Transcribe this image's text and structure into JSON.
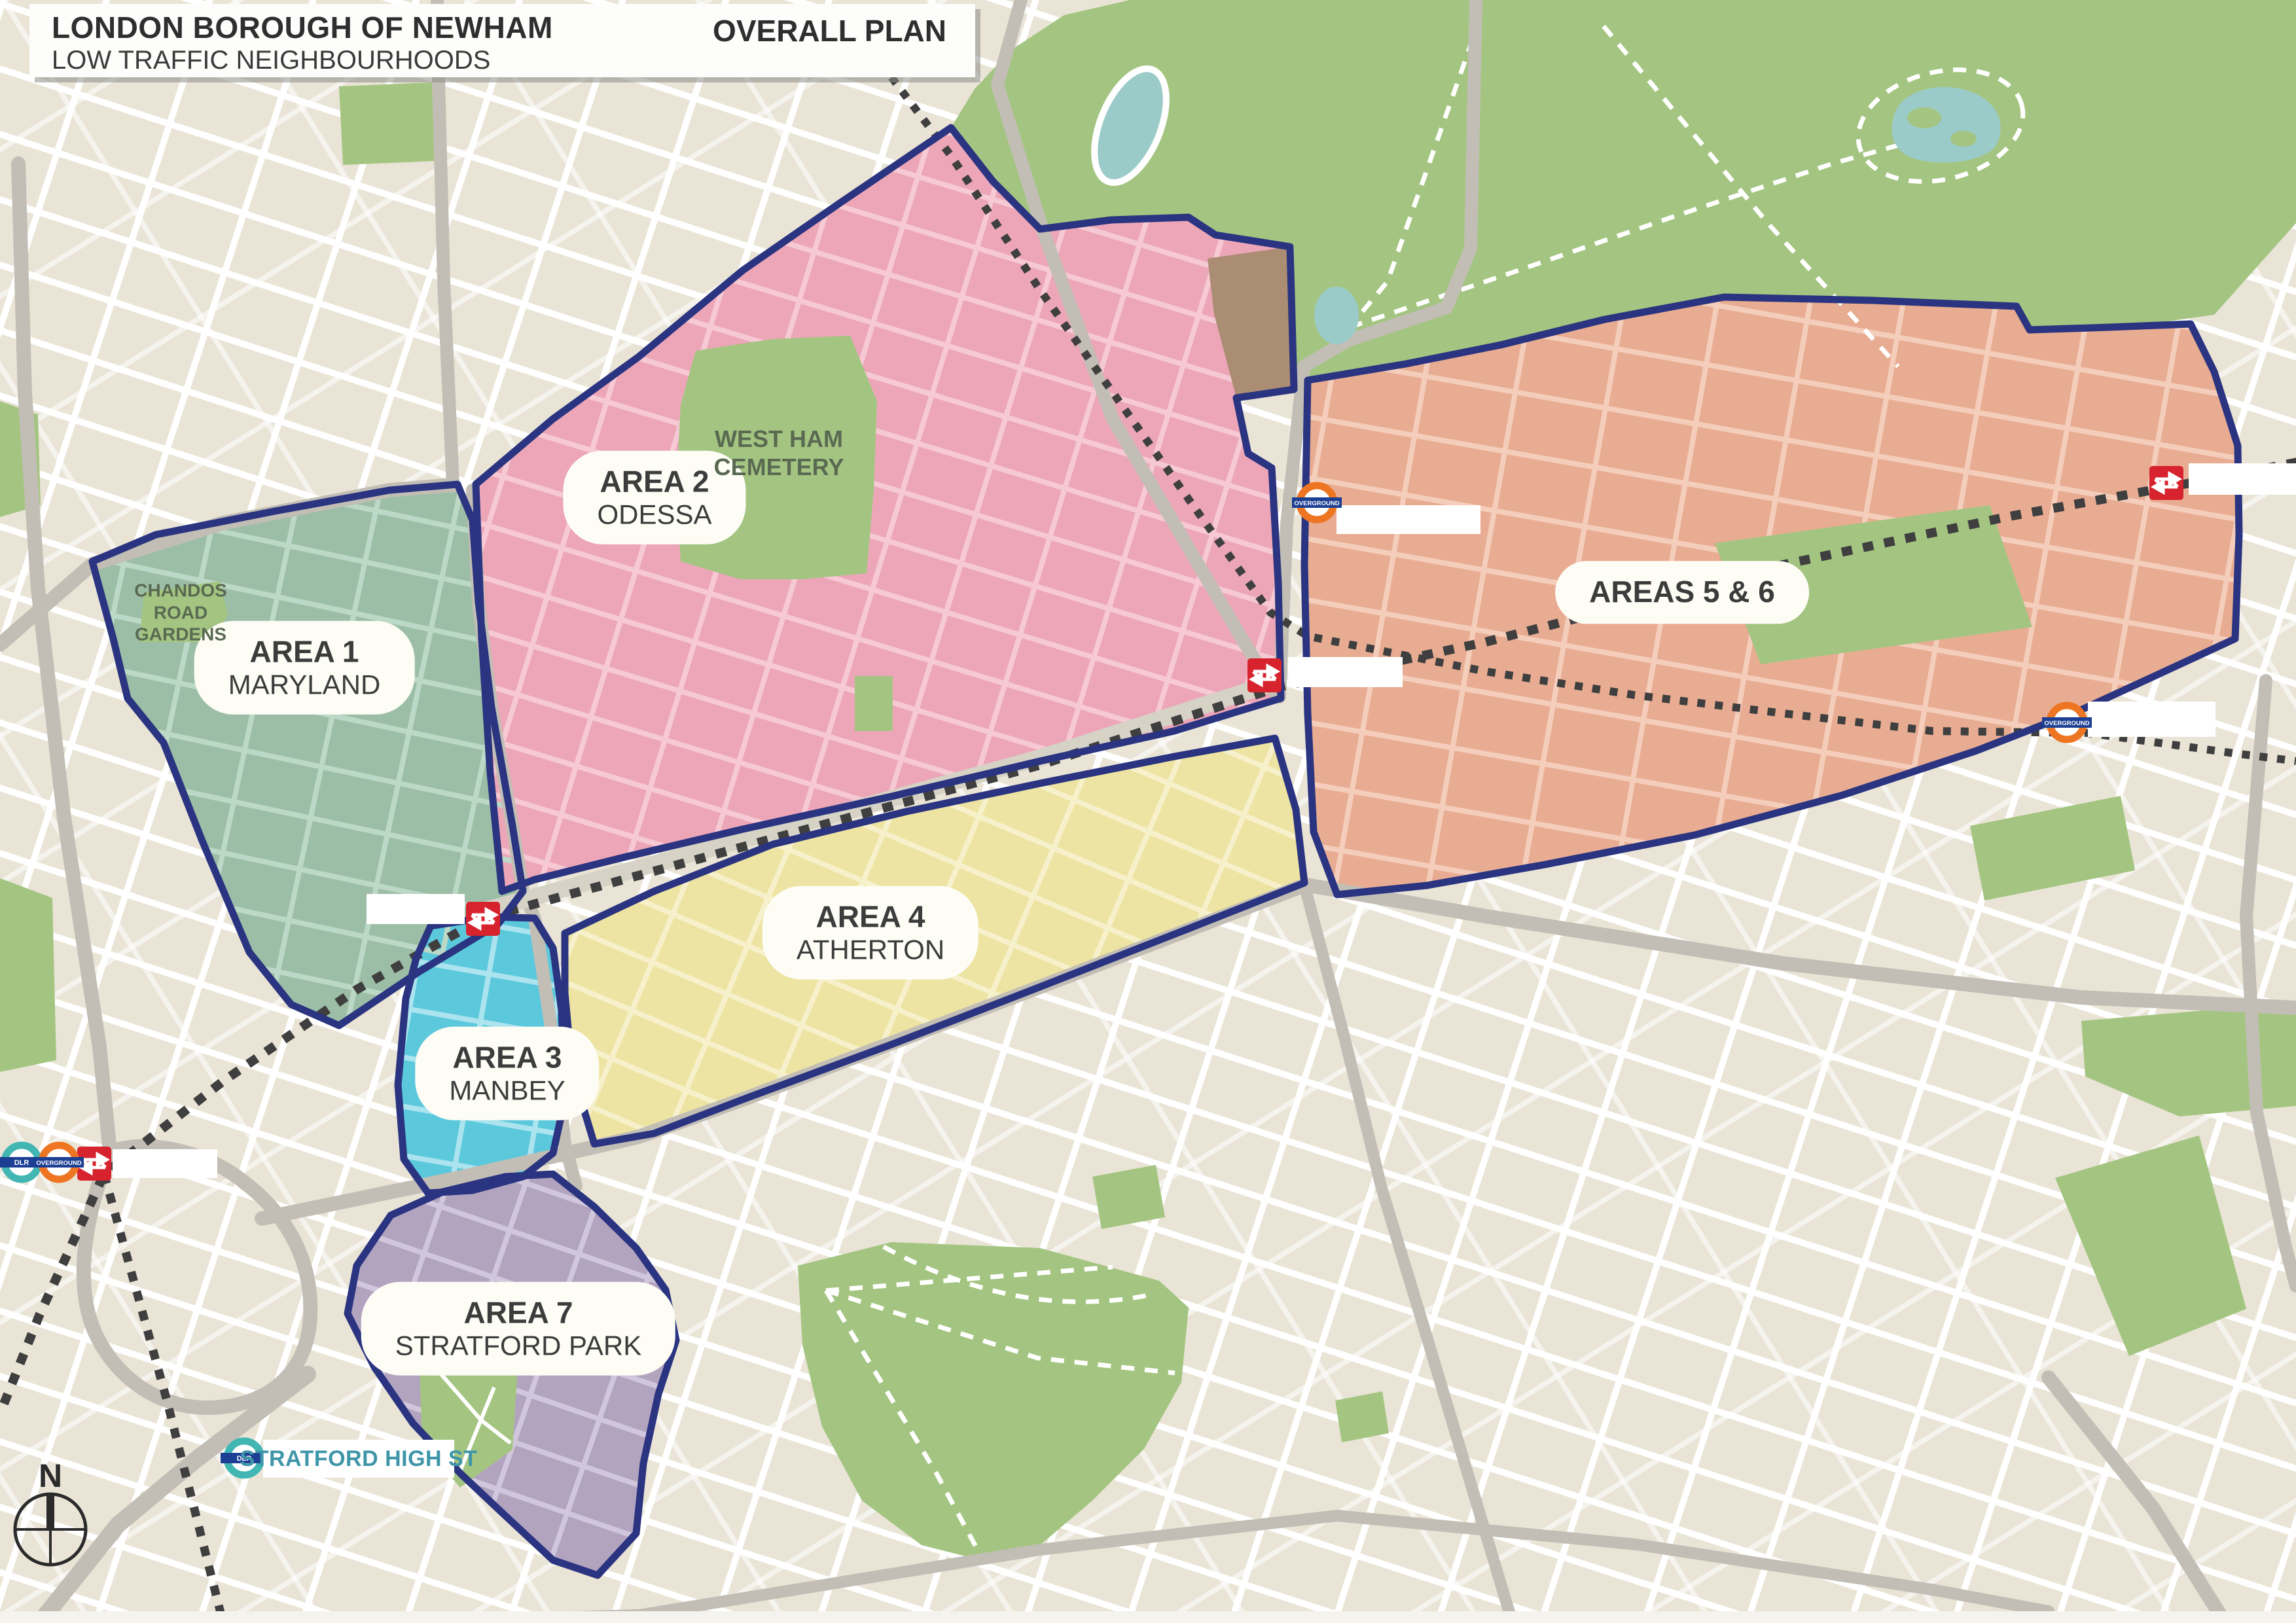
{
  "header": {
    "title": "LONDON BOROUGH OF NEWHAM",
    "subtitle": "LOW TRAFFIC NEIGHBOURHOODS",
    "plan_label": "OVERALL PLAN"
  },
  "areas": [
    {
      "id": "area-1",
      "name": "AREA 1",
      "subname": "MARYLAND",
      "color": "#9CBEA6",
      "street_color": "#BCD8C6"
    },
    {
      "id": "area-2",
      "name": "AREA 2",
      "subname": "ODESSA",
      "color": "#ECA6B8",
      "street_color": "#F6C9D4"
    },
    {
      "id": "area-3",
      "name": "AREA 3",
      "subname": "MANBEY",
      "color": "#5CC8DC",
      "street_color": "#ABE4EF"
    },
    {
      "id": "area-4",
      "name": "AREA 4",
      "subname": "ATHERTON",
      "color": "#EDE3A2",
      "street_color": "#F7F1CB"
    },
    {
      "id": "areas-5-6",
      "name": "AREAS 5 & 6",
      "subname": "",
      "color": "#E8AC92",
      "street_color": "#F4CDBB"
    },
    {
      "id": "area-7",
      "name": "AREA 7",
      "subname": "STRATFORD PARK",
      "color": "#B2A3BF",
      "street_color": "#D1C7DC"
    }
  ],
  "map_labels": {
    "cemetery": "WEST HAM CEMETERY",
    "gardens": "CHANDOS ROAD GARDENS",
    "stratford_high_st": "STRATFORD HIGH ST",
    "compass_north": "N"
  },
  "transit": {
    "overground_roundel_label": "OVERGROUND",
    "dlr_roundel_label": "DLR",
    "station_icons": [
      "maryland-national-rail-icon",
      "forest-gate-national-rail-icon",
      "manor-park-national-rail-icon",
      "stratford-national-rail-icon",
      "stratford-overground-roundel-icon",
      "stratford-dlr-roundel-icon",
      "wanstead-park-overground-roundel-icon",
      "woodgrange-park-overground-roundel-icon",
      "stratford-high-st-dlr-roundel-icon"
    ]
  },
  "colors": {
    "background": "#E9E4D6",
    "street_white": "#FFFFFF",
    "main_road_gray": "#C2BEB5",
    "park_green": "#A4C581",
    "boundary_navy": "#2A3480",
    "railway_dark": "#3F3F3F",
    "water_teal": "#9BCBC9",
    "brown_patch": "#AB8D74",
    "national_rail_red": "#D7232E",
    "overground_orange": "#EE7623",
    "dlr_teal": "#41B6B2",
    "roundel_bar_navy": "#1C3F94",
    "label_text": "#3C3C3C",
    "park_text_green": "#5A6A52",
    "stratford_high_st_text": "#3E96A8"
  }
}
